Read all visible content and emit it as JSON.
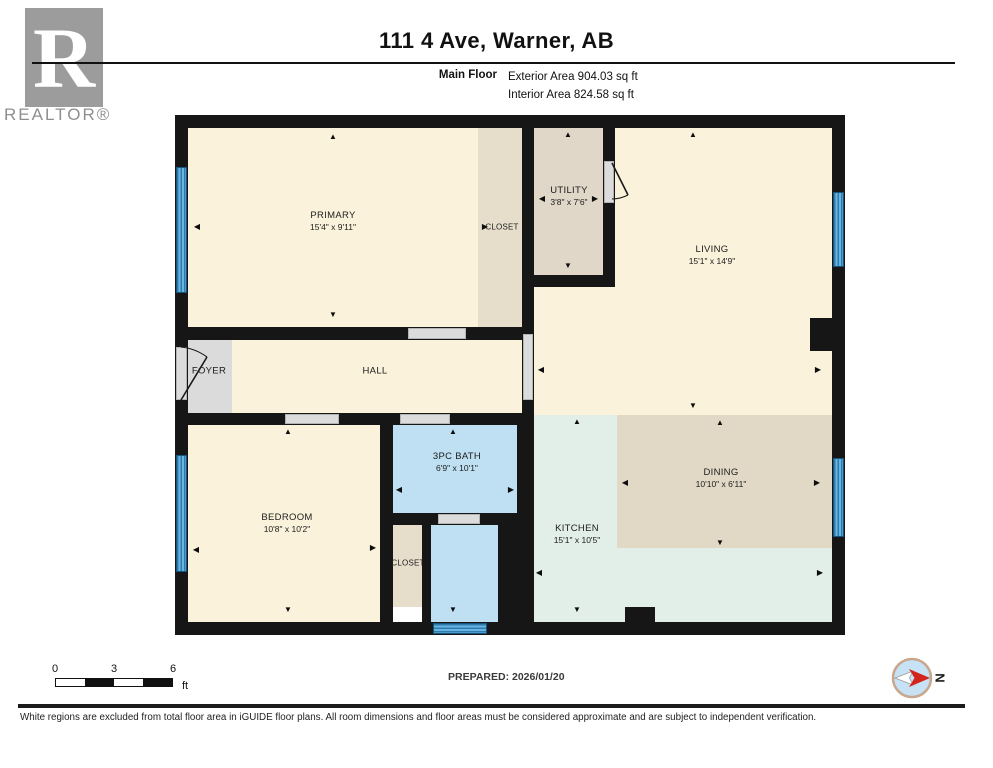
{
  "header": {
    "title": "111 4 Ave, Warner, AB",
    "floor_label": "Main Floor",
    "exterior_area": "Exterior Area 904.03 sq ft",
    "interior_area": "Interior Area 824.58 sq ft",
    "logo_letter": "R",
    "logo_text": "REALTOR®"
  },
  "plan": {
    "rooms": [
      {
        "id": "primary",
        "name": "PRIMARY",
        "dims": "15'4\" x 9'11\"",
        "label_x": 333,
        "label_y": 221
      },
      {
        "id": "primary-closet",
        "name": "CLOSET",
        "dims": "",
        "small": true,
        "label_x": 502,
        "label_y": 227
      },
      {
        "id": "utility",
        "name": "UTILITY",
        "dims": "3'8\" x 7'6\"",
        "label_x": 569,
        "label_y": 196
      },
      {
        "id": "living",
        "name": "LIVING",
        "dims": "15'1\" x 14'9\"",
        "label_x": 712,
        "label_y": 255
      },
      {
        "id": "foyer",
        "name": "FOYER",
        "dims": "",
        "label_x": 209,
        "label_y": 371
      },
      {
        "id": "hall",
        "name": "HALL",
        "dims": "",
        "label_x": 375,
        "label_y": 371
      },
      {
        "id": "bedroom",
        "name": "BEDROOM",
        "dims": "10'8\" x 10'2\"",
        "label_x": 287,
        "label_y": 523
      },
      {
        "id": "bath",
        "name": "3PC BATH",
        "dims": "6'9\" x 10'1\"",
        "label_x": 457,
        "label_y": 462
      },
      {
        "id": "bedroom-closet",
        "name": "CLOSET",
        "dims": "",
        "small": true,
        "label_x": 408,
        "label_y": 563
      },
      {
        "id": "kitchen",
        "name": "KITCHEN",
        "dims": "15'1\" x 10'5\"",
        "label_x": 577,
        "label_y": 534
      },
      {
        "id": "dining",
        "name": "DINING",
        "dims": "10'10\" x 6'11\"",
        "label_x": 721,
        "label_y": 478
      }
    ],
    "arrows": [
      {
        "x": 333,
        "y": 137,
        "dir": "up"
      },
      {
        "x": 333,
        "y": 315,
        "dir": "down"
      },
      {
        "x": 197,
        "y": 227,
        "dir": "left"
      },
      {
        "x": 485,
        "y": 227,
        "dir": "right"
      },
      {
        "x": 568,
        "y": 135,
        "dir": "up"
      },
      {
        "x": 568,
        "y": 266,
        "dir": "down"
      },
      {
        "x": 542,
        "y": 199,
        "dir": "left"
      },
      {
        "x": 595,
        "y": 199,
        "dir": "right"
      },
      {
        "x": 693,
        "y": 135,
        "dir": "up"
      },
      {
        "x": 693,
        "y": 406,
        "dir": "down"
      },
      {
        "x": 541,
        "y": 370,
        "dir": "left"
      },
      {
        "x": 818,
        "y": 370,
        "dir": "right"
      },
      {
        "x": 288,
        "y": 432,
        "dir": "up"
      },
      {
        "x": 288,
        "y": 610,
        "dir": "down"
      },
      {
        "x": 196,
        "y": 550,
        "dir": "left"
      },
      {
        "x": 373,
        "y": 548,
        "dir": "right"
      },
      {
        "x": 453,
        "y": 432,
        "dir": "up"
      },
      {
        "x": 399,
        "y": 490,
        "dir": "left"
      },
      {
        "x": 511,
        "y": 490,
        "dir": "right"
      },
      {
        "x": 453,
        "y": 610,
        "dir": "down"
      },
      {
        "x": 577,
        "y": 422,
        "dir": "up"
      },
      {
        "x": 577,
        "y": 610,
        "dir": "down"
      },
      {
        "x": 539,
        "y": 573,
        "dir": "left"
      },
      {
        "x": 820,
        "y": 573,
        "dir": "right"
      },
      {
        "x": 720,
        "y": 423,
        "dir": "up"
      },
      {
        "x": 720,
        "y": 543,
        "dir": "down"
      },
      {
        "x": 625,
        "y": 483,
        "dir": "left"
      },
      {
        "x": 817,
        "y": 483,
        "dir": "right"
      }
    ],
    "colors": {
      "wall": "#161616",
      "cream": "#FAF2DA",
      "tan": "#E2D8C6",
      "closet_tan": "#E6DDCB",
      "utility_tan": "#E0D7C8",
      "kitchen_green": "#E2EEE8",
      "bath_blue": "#BEE0F2",
      "foyer_gray": "#DBDBDB",
      "window_blue": "#69B4E0",
      "door_gray": "#DCDCDC"
    }
  },
  "footer": {
    "scale": {
      "labels": [
        "0",
        "3",
        "6"
      ],
      "unit": "ft"
    },
    "prepared": "PREPARED: 2026/01/20",
    "compass_label": "N",
    "disclaimer": "White regions are excluded from total floor area in iGUIDE floor plans. All room dimensions and floor areas must be considered approximate and are subject to independent verification."
  }
}
